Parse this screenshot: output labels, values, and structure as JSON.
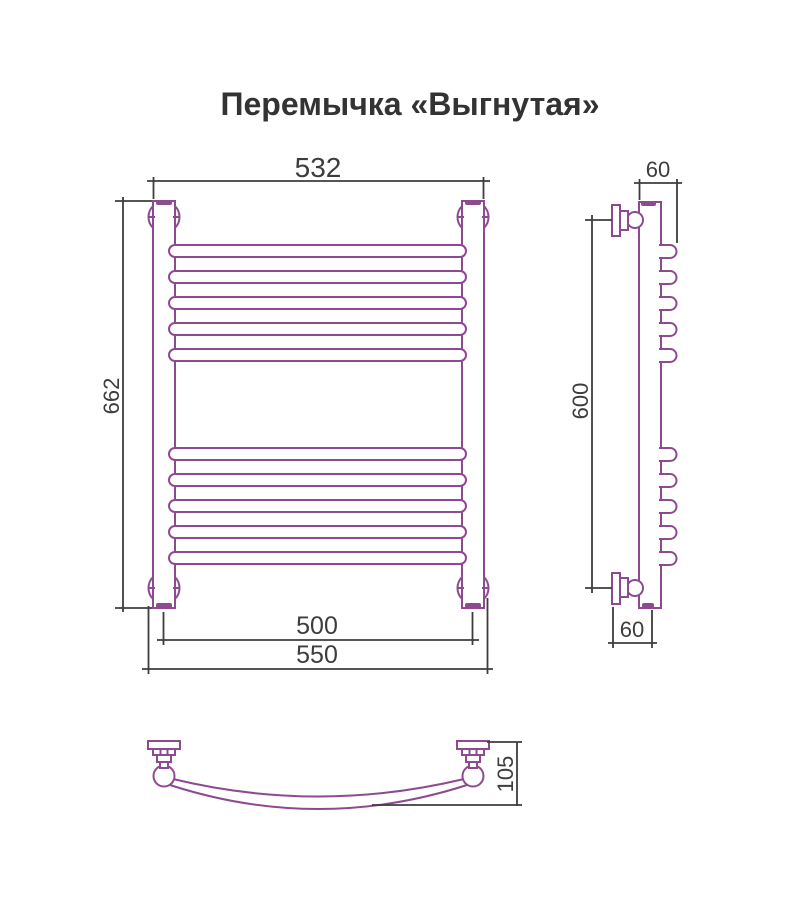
{
  "title": "Перемычка «Выгнутая»",
  "colors": {
    "product": "#8e4a91",
    "dimension": "#3d3d3d",
    "text": "#3a3a3a",
    "background": "#ffffff"
  },
  "dimensions": {
    "front": {
      "mount_width": "532",
      "total_height": "662",
      "axis_width": "500",
      "overall_width": "550"
    },
    "side": {
      "top_depth": "60",
      "mount_height": "600",
      "bottom_depth": "60"
    },
    "bottom": {
      "protrusion": "105"
    }
  }
}
